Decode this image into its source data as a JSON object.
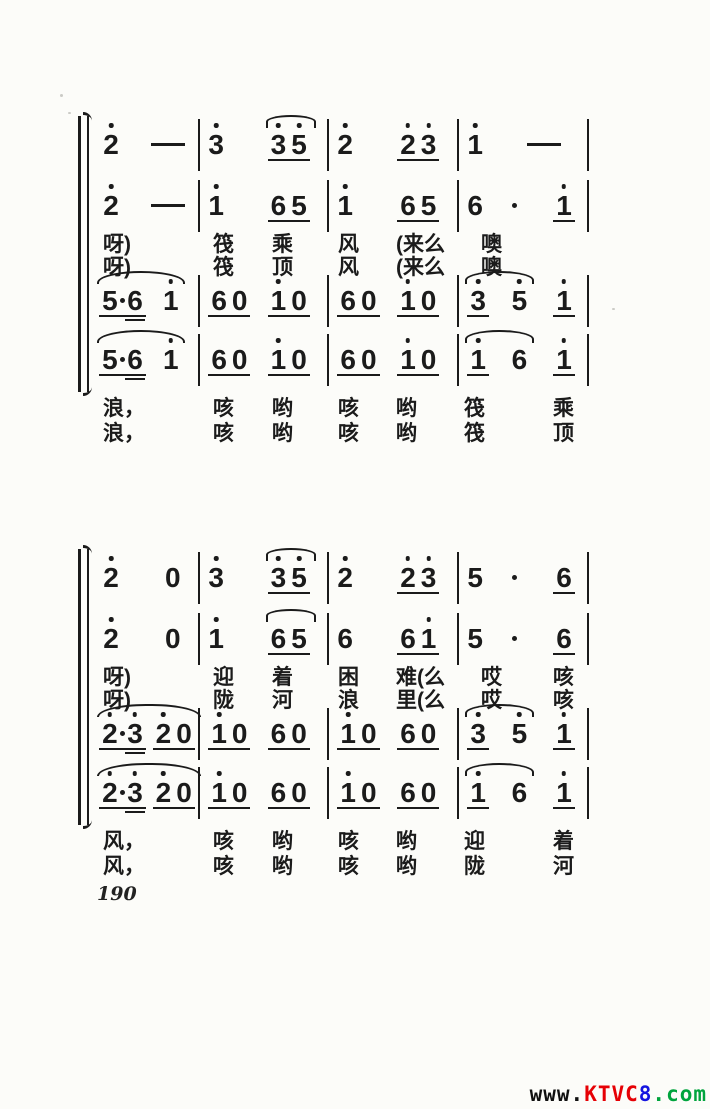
{
  "page": {
    "number": "190"
  },
  "watermark": {
    "segments": [
      {
        "text": "www.",
        "color": "#101010"
      },
      {
        "text": "KTVC",
        "color": "#e60005"
      },
      {
        "text": "8",
        "color": "#1515e0"
      },
      {
        "text": ".com",
        "color": "#00a43d"
      }
    ]
  },
  "score": {
    "ink": "#1b1b1b",
    "notation": "jianpu",
    "systems": [
      {
        "voices_upper": [
          [
            {
              "c": [
                {
                  "n": [
                    "2'"
                  ]
                },
                {
                  "n": [
                    "—"
                  ]
                }
              ]
            },
            {
              "c": [
                {
                  "n": [
                    "3'"
                  ]
                },
                {
                  "n": [
                    "3'",
                    "5'"
                  ],
                  "u": 1
                }
              ],
              "s": [
                1,
                1
              ]
            },
            {
              "c": [
                {
                  "n": [
                    "2'"
                  ]
                },
                {
                  "n": [
                    "2'",
                    "3'"
                  ],
                  "u": 1
                }
              ]
            },
            {
              "c": [
                {
                  "n": [
                    "1'"
                  ]
                },
                {
                  "n": [
                    "—"
                  ]
                }
              ]
            }
          ],
          [
            {
              "c": [
                {
                  "n": [
                    "2'"
                  ]
                },
                {
                  "n": [
                    "—"
                  ]
                }
              ]
            },
            {
              "c": [
                {
                  "n": [
                    "1'"
                  ]
                },
                {
                  "n": [
                    "6",
                    "5"
                  ],
                  "u": 1
                }
              ]
            },
            {
              "c": [
                {
                  "n": [
                    "1'"
                  ]
                },
                {
                  "n": [
                    "6",
                    "5"
                  ],
                  "u": 1
                }
              ]
            },
            {
              "c": [
                {
                  "n": [
                    "6"
                  ]
                },
                {
                  "n": [
                    "·"
                  ]
                },
                {
                  "n": [
                    "1'"
                  ],
                  "u": 1
                }
              ]
            }
          ]
        ],
        "lyrics_upper": [
          [
            "呀)",
            "筏",
            "乘",
            "风",
            "(来么",
            "",
            "噢",
            ""
          ],
          [
            "呀)",
            "筏",
            "顶",
            "风",
            "(来么",
            "",
            "噢",
            ""
          ]
        ],
        "voices_lower": [
          [
            {
              "c": [
                {
                  "n": [
                    "5",
                    "·",
                    "6_"
                  ],
                  "u": 1
                },
                {
                  "n": [
                    "1'"
                  ]
                }
              ],
              "s": [
                0,
                1
              ]
            },
            {
              "c": [
                {
                  "n": [
                    "6",
                    "0"
                  ],
                  "u": 1
                },
                {
                  "n": [
                    "1'",
                    "0"
                  ],
                  "u": 1
                }
              ]
            },
            {
              "c": [
                {
                  "n": [
                    "6",
                    "0"
                  ],
                  "u": 1
                },
                {
                  "n": [
                    "1'",
                    "0"
                  ],
                  "u": 1
                }
              ]
            },
            {
              "c": [
                {
                  "n": [
                    "3'"
                  ],
                  "u": 1
                },
                {
                  "n": [
                    "5'"
                  ]
                },
                {
                  "n": [
                    "1'"
                  ],
                  "u": 1
                }
              ],
              "s": [
                0,
                1
              ]
            }
          ],
          [
            {
              "c": [
                {
                  "n": [
                    "5",
                    "·",
                    "6_"
                  ],
                  "u": 1
                },
                {
                  "n": [
                    "1'"
                  ]
                }
              ],
              "s": [
                0,
                1
              ]
            },
            {
              "c": [
                {
                  "n": [
                    "6",
                    "0"
                  ],
                  "u": 1
                },
                {
                  "n": [
                    "1'",
                    "0"
                  ],
                  "u": 1
                }
              ]
            },
            {
              "c": [
                {
                  "n": [
                    "6",
                    "0"
                  ],
                  "u": 1
                },
                {
                  "n": [
                    "1'",
                    "0"
                  ],
                  "u": 1
                }
              ]
            },
            {
              "c": [
                {
                  "n": [
                    "1'"
                  ],
                  "u": 1
                },
                {
                  "n": [
                    "6"
                  ]
                },
                {
                  "n": [
                    "1'"
                  ],
                  "u": 1
                }
              ],
              "s": [
                0,
                1
              ]
            }
          ]
        ],
        "lyrics_lower": [
          [
            "浪，",
            "咳",
            "哟",
            "咳",
            "哟",
            "筏",
            "",
            "乘"
          ],
          [
            "浪，",
            "咳",
            "哟",
            "咳",
            "哟",
            "筏",
            "",
            "顶"
          ]
        ]
      },
      {
        "voices_upper": [
          [
            {
              "c": [
                {
                  "n": [
                    "2'"
                  ]
                },
                {
                  "n": [
                    "0"
                  ]
                }
              ]
            },
            {
              "c": [
                {
                  "n": [
                    "3'"
                  ]
                },
                {
                  "n": [
                    "3'",
                    "5'"
                  ],
                  "u": 1
                }
              ],
              "s": [
                1,
                1
              ]
            },
            {
              "c": [
                {
                  "n": [
                    "2'"
                  ]
                },
                {
                  "n": [
                    "2'",
                    "3'"
                  ],
                  "u": 1
                }
              ]
            },
            {
              "c": [
                {
                  "n": [
                    "5"
                  ]
                },
                {
                  "n": [
                    "·"
                  ]
                },
                {
                  "n": [
                    "6"
                  ],
                  "u": 1
                }
              ]
            }
          ],
          [
            {
              "c": [
                {
                  "n": [
                    "2'"
                  ]
                },
                {
                  "n": [
                    "0"
                  ]
                }
              ]
            },
            {
              "c": [
                {
                  "n": [
                    "1'"
                  ]
                },
                {
                  "n": [
                    "6",
                    "5"
                  ],
                  "u": 1
                }
              ],
              "s": [
                1,
                1
              ]
            },
            {
              "c": [
                {
                  "n": [
                    "6"
                  ]
                },
                {
                  "n": [
                    "6",
                    "1'"
                  ],
                  "u": 1
                }
              ]
            },
            {
              "c": [
                {
                  "n": [
                    "5"
                  ]
                },
                {
                  "n": [
                    "·"
                  ]
                },
                {
                  "n": [
                    "6"
                  ],
                  "u": 1
                }
              ]
            }
          ]
        ],
        "lyrics_upper": [
          [
            "呀)",
            "迎",
            "着",
            "困",
            "难(么",
            "",
            "哎",
            "咳"
          ],
          [
            "呀)",
            "陇",
            "河",
            "浪",
            "里(么",
            "",
            "哎",
            "咳"
          ]
        ],
        "voices_lower": [
          [
            {
              "c": [
                {
                  "n": [
                    "2'",
                    "·",
                    "3'_"
                  ],
                  "u": 1
                },
                {
                  "n": [
                    "2'",
                    "0"
                  ],
                  "u": 1
                }
              ],
              "s": [
                0,
                1
              ]
            },
            {
              "c": [
                {
                  "n": [
                    "1'",
                    "0"
                  ],
                  "u": 1
                },
                {
                  "n": [
                    "6",
                    "0"
                  ],
                  "u": 1
                }
              ]
            },
            {
              "c": [
                {
                  "n": [
                    "1'",
                    "0"
                  ],
                  "u": 1
                },
                {
                  "n": [
                    "6",
                    "0"
                  ],
                  "u": 1
                }
              ]
            },
            {
              "c": [
                {
                  "n": [
                    "3'"
                  ],
                  "u": 1
                },
                {
                  "n": [
                    "5'"
                  ]
                },
                {
                  "n": [
                    "1'"
                  ],
                  "u": 1
                }
              ],
              "s": [
                0,
                1
              ]
            }
          ],
          [
            {
              "c": [
                {
                  "n": [
                    "2'",
                    "·",
                    "3'_"
                  ],
                  "u": 1
                },
                {
                  "n": [
                    "2'",
                    "0"
                  ],
                  "u": 1
                }
              ],
              "s": [
                0,
                1
              ]
            },
            {
              "c": [
                {
                  "n": [
                    "1'",
                    "0"
                  ],
                  "u": 1
                },
                {
                  "n": [
                    "6",
                    "0"
                  ],
                  "u": 1
                }
              ]
            },
            {
              "c": [
                {
                  "n": [
                    "1'",
                    "0"
                  ],
                  "u": 1
                },
                {
                  "n": [
                    "6",
                    "0"
                  ],
                  "u": 1
                }
              ]
            },
            {
              "c": [
                {
                  "n": [
                    "1'"
                  ],
                  "u": 1
                },
                {
                  "n": [
                    "6"
                  ]
                },
                {
                  "n": [
                    "1'"
                  ],
                  "u": 1
                }
              ],
              "s": [
                0,
                1
              ]
            }
          ]
        ],
        "lyrics_lower": [
          [
            "风，",
            "咳",
            "哟",
            "咳",
            "哟",
            "迎",
            "",
            "着"
          ],
          [
            "风，",
            "咳",
            "哟",
            "咳",
            "哟",
            "陇",
            "",
            "河"
          ]
        ]
      }
    ]
  }
}
